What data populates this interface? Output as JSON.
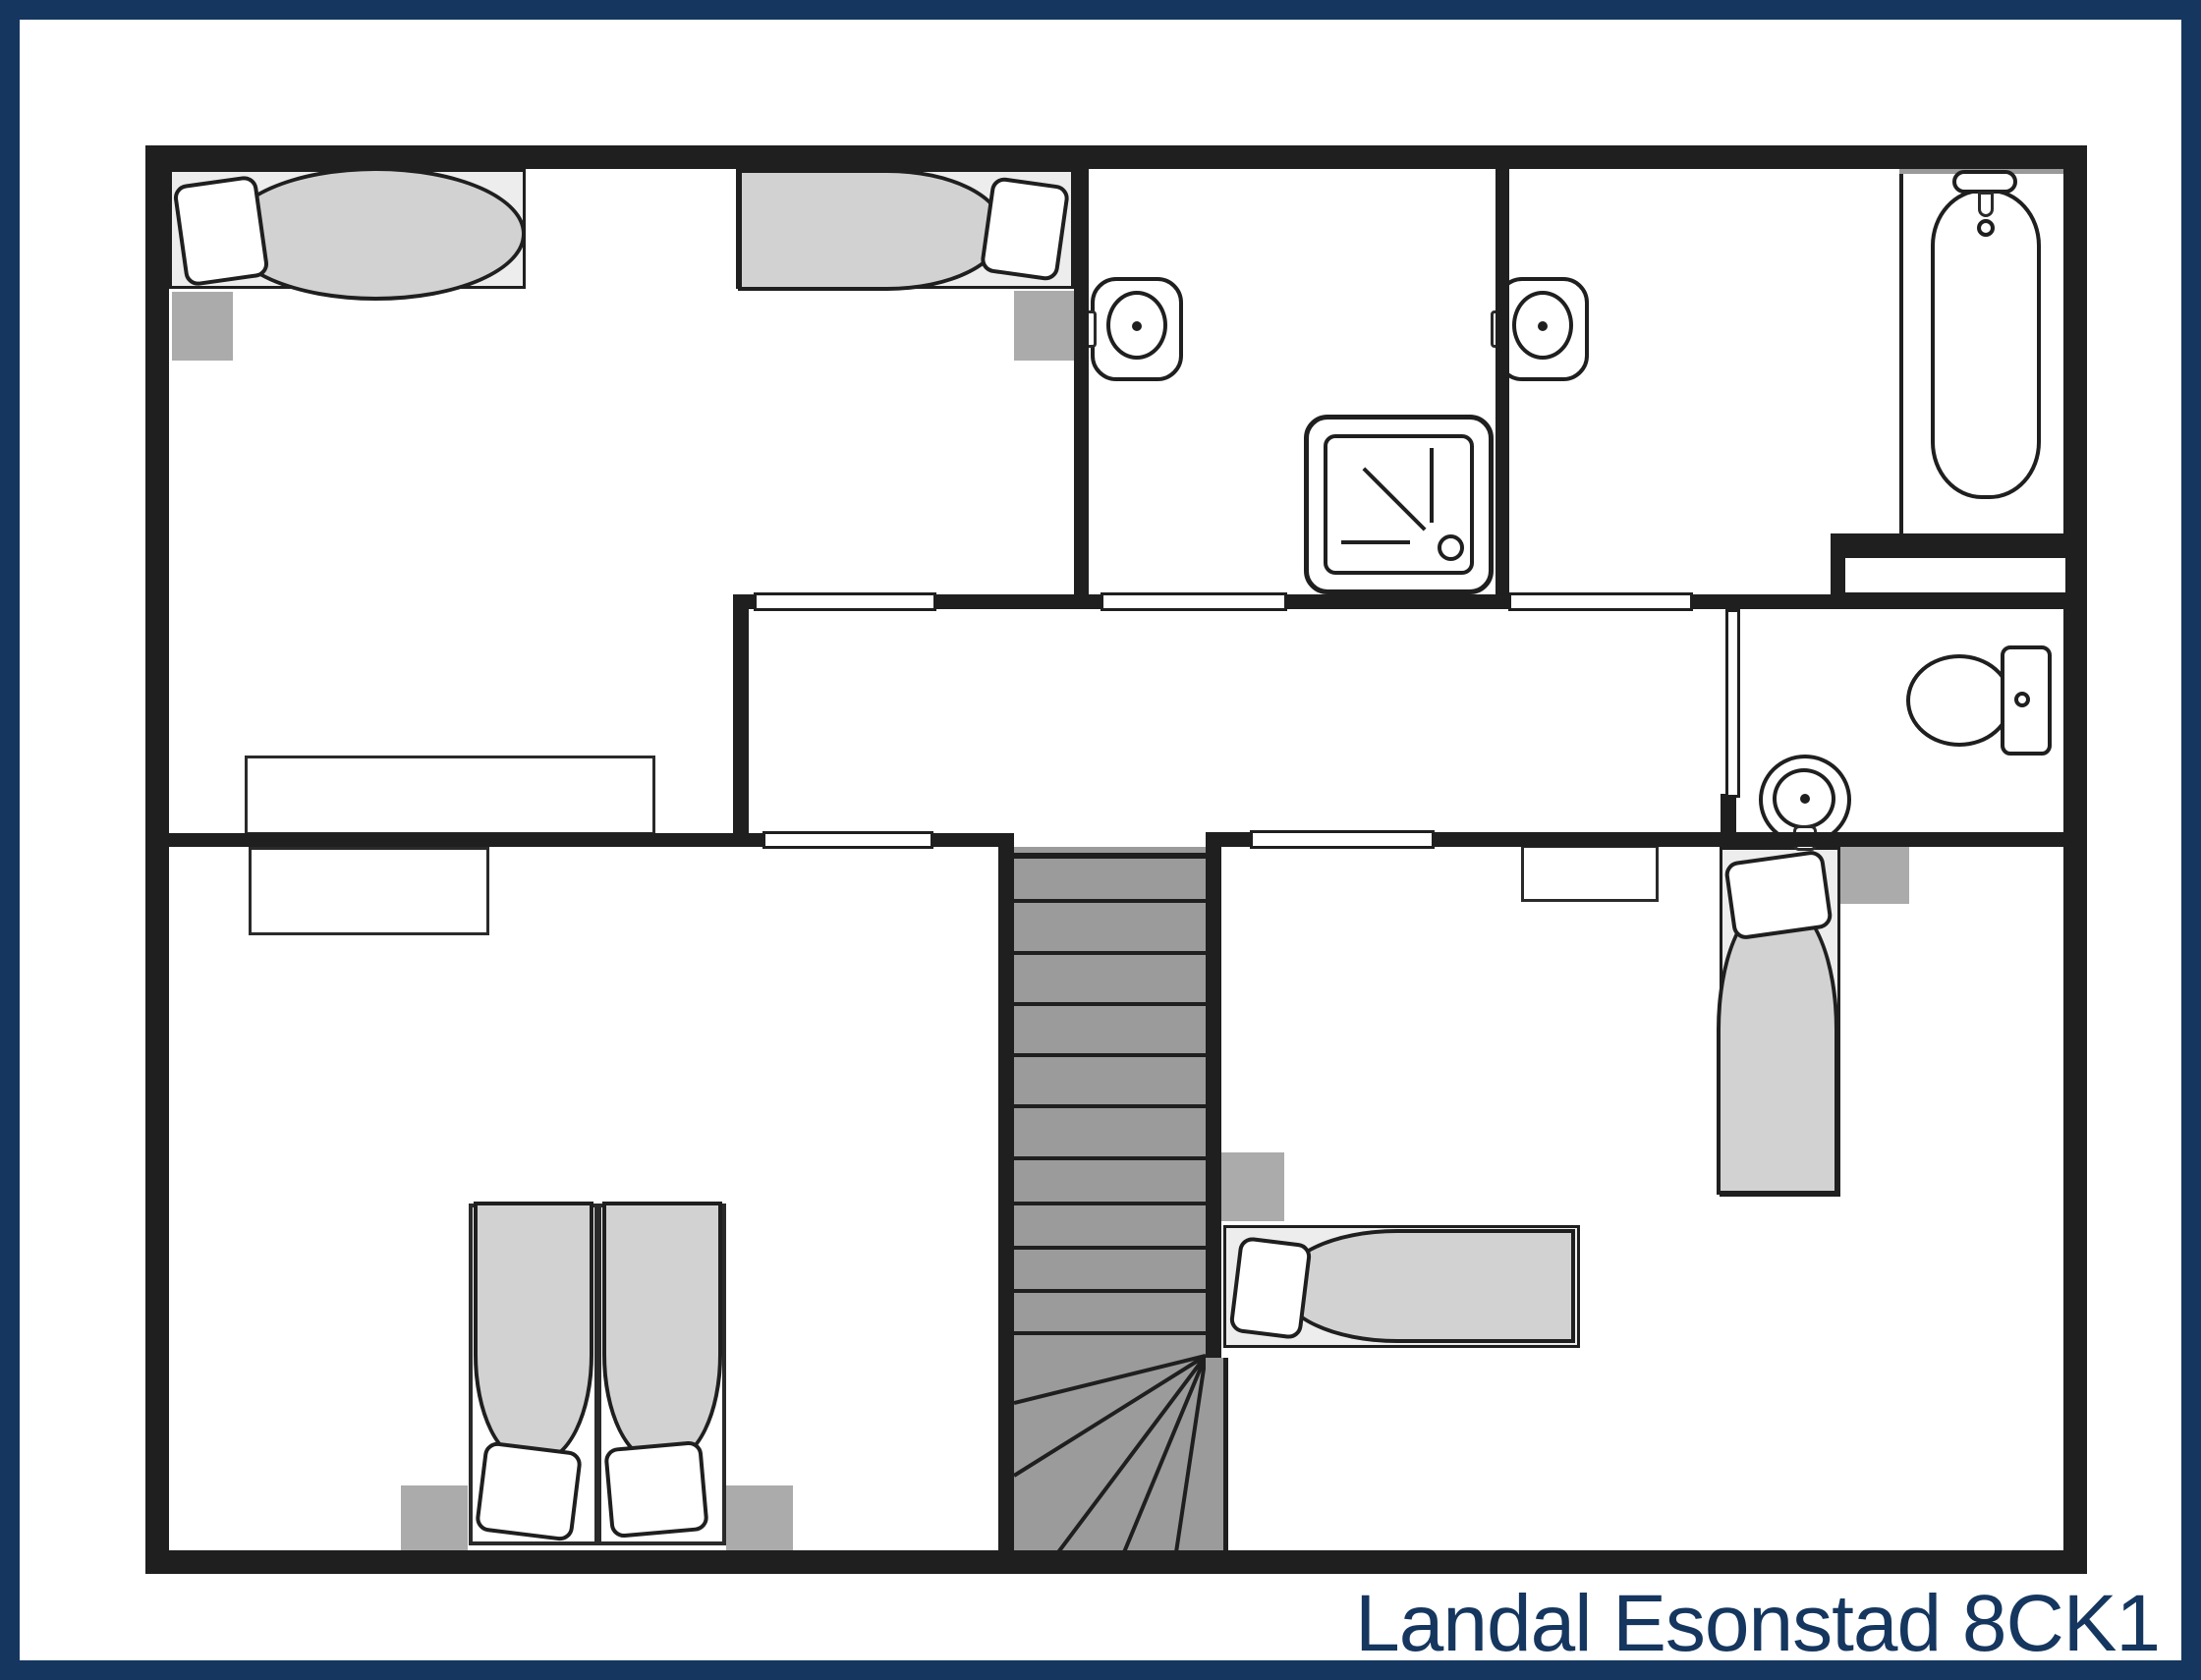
{
  "caption": "Landal Esonstad 8CK1",
  "colors": {
    "navy": "#15365e",
    "wall": "#1f1f1f",
    "duvet": "#d2d2d2",
    "frame": "#ededed",
    "stand": "#ababab",
    "stairs": "#9b9b9b",
    "caption": "#15365e"
  },
  "legend": {
    "type": "floor-plan",
    "fixtures": [
      "single-bed",
      "double-bed",
      "pillow",
      "duvet",
      "nightstand",
      "toilet",
      "wash-basin",
      "shower-tray",
      "bathtub",
      "staircase-with-winders",
      "door-opening",
      "wardrobe"
    ]
  }
}
